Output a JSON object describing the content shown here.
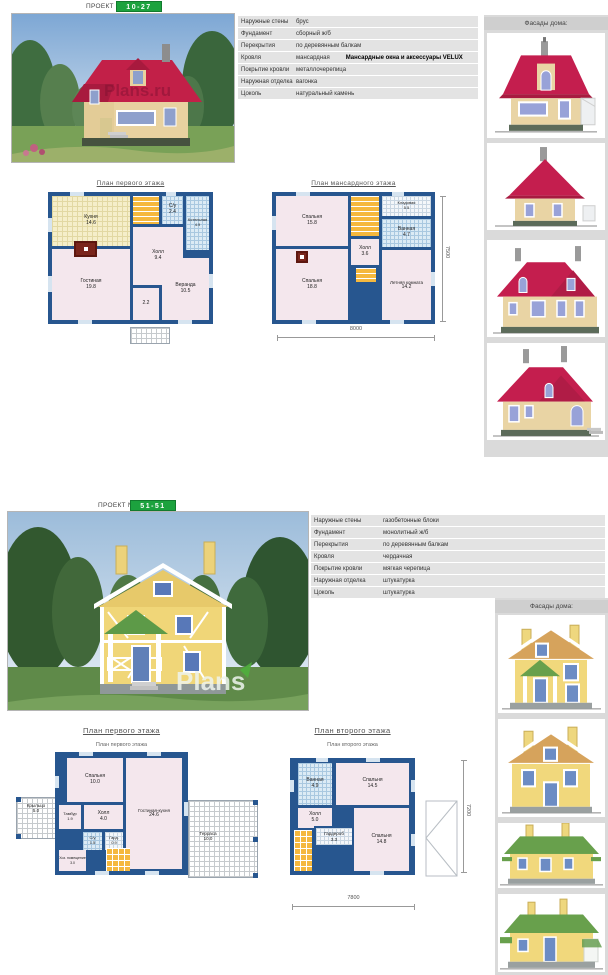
{
  "colors": {
    "badge_green": "#1ca23e",
    "wall_blue": "#27568f",
    "room_pink": "#f4e7ed",
    "stairs_orange": "#f5b83e",
    "roof_red": "#c41e4e",
    "facade_wall_beige": "#e9d4a4",
    "p2_wall_yellow": "#f1d87c",
    "p2_roof_green": "#68a04c",
    "window_blue": "#98a2d8"
  },
  "project1": {
    "header": {
      "label": "ПРОЕКТ №",
      "number": "10-27"
    },
    "photo_watermark": "Plans.ru",
    "facades_title": "Фасады дома:",
    "specs": [
      {
        "label": "Наружные стены",
        "value": "брус"
      },
      {
        "label": "Фундамент",
        "value": "сборный ж/б"
      },
      {
        "label": "Перекрытия",
        "value": "по деревянным балкам"
      },
      {
        "label": "Кровля",
        "value": "мансардная",
        "extra": "Мансардные окна и аксессуары VELUX"
      },
      {
        "label": "Покрытие кровли",
        "value": "металлочерепица"
      },
      {
        "label": "Наружная отделка",
        "value": "вагонка"
      },
      {
        "label": "Цоколь",
        "value": "натуральный камень"
      }
    ],
    "plan1": {
      "title": "План первого этажа",
      "rooms": [
        {
          "name": "Кухня",
          "area": "14.6"
        },
        {
          "name": "Холл",
          "area": "9.4"
        },
        {
          "name": "С/у",
          "area": "2.4"
        },
        {
          "name": "Котельная",
          "area": "4.9"
        },
        {
          "name": "Гостиная",
          "area": "19.8"
        },
        {
          "name": "Веранда",
          "area": "10.5"
        },
        {
          "name": "",
          "area": "2.2"
        }
      ]
    },
    "plan2": {
      "title": "План мансардного этажа",
      "rooms": [
        {
          "name": "Спальня",
          "area": "15.8"
        },
        {
          "name": "Кладовая",
          "area": "5.5"
        },
        {
          "name": "Ванная",
          "area": "4.7"
        },
        {
          "name": "Холл",
          "area": "3.6"
        },
        {
          "name": "Спальня",
          "area": "18.8"
        },
        {
          "name": "Летняя комната",
          "area": "14.2"
        }
      ],
      "dims": {
        "bottom": "8000",
        "right": "7500"
      }
    }
  },
  "project2": {
    "header": {
      "label": "ПРОЕКТ №",
      "number": "51-51"
    },
    "photo_watermark": "Plans",
    "facades_title": "Фасады дома:",
    "specs": [
      {
        "label": "Наружные стены",
        "value": "газобетонные блоки"
      },
      {
        "label": "Фундамент",
        "value": "монолитный ж/б"
      },
      {
        "label": "Перекрытия",
        "value": "по деревянным балкам"
      },
      {
        "label": "Кровля",
        "value": "чердачная"
      },
      {
        "label": "Покрытие кровли",
        "value": "мягкая черепица"
      },
      {
        "label": "Наружная отделка",
        "value": "штукатурка"
      },
      {
        "label": "Цоколь",
        "value": "штукатурка"
      }
    ],
    "plan1": {
      "title": "План первого этажа",
      "subtitle": "План первого этажа",
      "rooms": [
        {
          "name": "Спальня",
          "area": "10.0"
        },
        {
          "name": "Гостиная-кухня",
          "area": "24.6"
        },
        {
          "name": "Тамбур",
          "area": "1.9"
        },
        {
          "name": "Холл",
          "area": "4.0"
        },
        {
          "name": "С/у",
          "area": "1.5"
        },
        {
          "name": "Гард.",
          "area": "0.9"
        },
        {
          "name": "Хоз. помещение",
          "area": "3.0"
        },
        {
          "name": "Крыльцо",
          "area": "5.0"
        },
        {
          "name": "Терраса",
          "area": "10.0"
        }
      ]
    },
    "plan2": {
      "title": "План второго этажа",
      "subtitle": "План второго этажа",
      "rooms": [
        {
          "name": "Ванная",
          "area": "4.9"
        },
        {
          "name": "Спальня",
          "area": "14.5"
        },
        {
          "name": "Холл",
          "area": "5.0"
        },
        {
          "name": "Гардероб",
          "area": "3.3"
        },
        {
          "name": "Спальня",
          "area": "14.8"
        }
      ],
      "dims": {
        "bottom": "7800",
        "right": "7200"
      }
    }
  }
}
